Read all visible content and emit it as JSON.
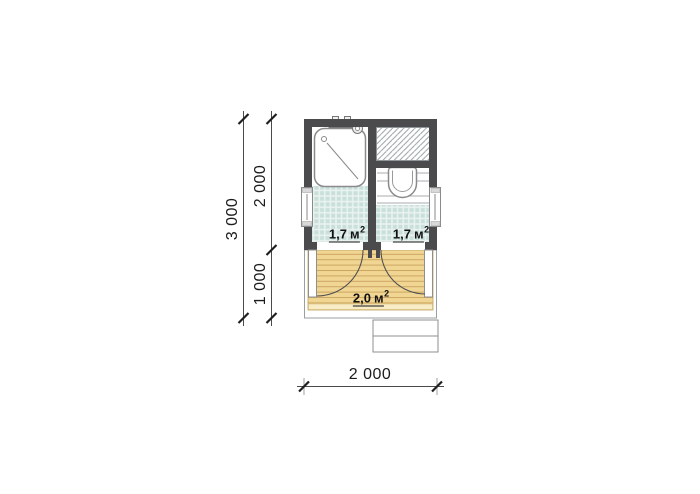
{
  "drawing": {
    "type": "floor-plan",
    "rooms": [
      {
        "id": "shower-room",
        "area": {
          "num": "1,7",
          "unit": "м",
          "sup": "2"
        }
      },
      {
        "id": "toilet-room",
        "area": {
          "num": "1,7",
          "unit": "м",
          "sup": "2"
        }
      },
      {
        "id": "porch",
        "area": {
          "num": "2,0",
          "unit": "м",
          "sup": "2"
        }
      }
    ],
    "dimensions": {
      "total_depth": "3 000",
      "rooms_depth": "2 000",
      "porch_depth": "1 000",
      "width": "2 000"
    },
    "colors": {
      "wall": "#4b4b4e",
      "tile": "#c9e0da",
      "tile_grout": "#e9f2ef",
      "wood": "#f0d593",
      "wood_line": "#cda761",
      "deck_light": "#f7ecc6",
      "line": "#4a4a4a"
    }
  }
}
